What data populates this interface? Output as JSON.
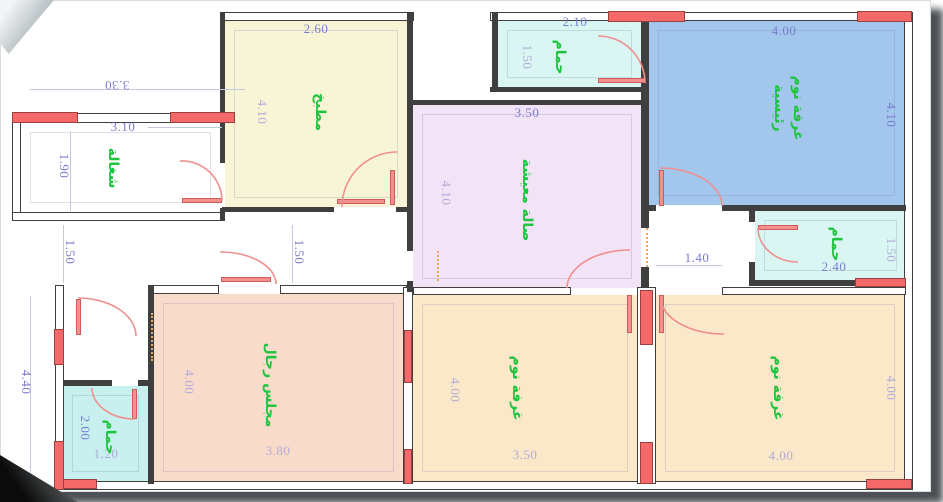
{
  "page": {
    "type": "architectural-floor-plan"
  },
  "colors": {
    "wall": "#3f3f3f",
    "window_red": "#f46969",
    "door_red": "#ef8f8f",
    "dim_strong": "#7a7ccd",
    "dim_light": "#b2abd8",
    "room_label_green": "#1ec43e",
    "kitchen_fill": "#f8f5d7",
    "master_bedroom_fill": "#a2c6ec",
    "living_fill": "#f3e3f7",
    "bathroom_fill": "#d9f6f2",
    "small_bathroom_fill": "#c8f0ee",
    "majlis_fill": "#f9dbcb",
    "bedroom_fill": "#fbe8c9"
  },
  "rooms": [
    {
      "id": "maid-room",
      "name": "شغالة"
    },
    {
      "id": "kitchen",
      "name": "مطبخ"
    },
    {
      "id": "bathroom-top",
      "name": "حمام"
    },
    {
      "id": "master-bedroom",
      "name": "غرفة نوم",
      "name2": "رئيسية"
    },
    {
      "id": "living-room",
      "name": "صالة معيشة"
    },
    {
      "id": "bathroom-right",
      "name": "حمام"
    },
    {
      "id": "bathroom-left",
      "name": "حمام"
    },
    {
      "id": "majlis",
      "name": "مجلس رجال"
    },
    {
      "id": "bedroom-middle",
      "name": "غرفة نوم"
    },
    {
      "id": "bedroom-right",
      "name": "غرفة نوم"
    }
  ],
  "dimensions": [
    {
      "value": "3.30"
    },
    {
      "value": "3.10"
    },
    {
      "value": "1.90"
    },
    {
      "value": "2.60"
    },
    {
      "value": "4.10"
    },
    {
      "value": "2.10"
    },
    {
      "value": "1.50"
    },
    {
      "value": "4.00"
    },
    {
      "value": "4.10"
    },
    {
      "value": "3.50"
    },
    {
      "value": "4.10"
    },
    {
      "value": "1.50"
    },
    {
      "value": "1.50"
    },
    {
      "value": "1.40"
    },
    {
      "value": "2.40"
    },
    {
      "value": "1.50"
    },
    {
      "value": "4.40"
    },
    {
      "value": "2.00"
    },
    {
      "value": "1.20"
    },
    {
      "value": "4.00"
    },
    {
      "value": "3.80"
    },
    {
      "value": "4.00"
    },
    {
      "value": "3.50"
    },
    {
      "value": "4.00"
    },
    {
      "value": "4.00"
    }
  ]
}
